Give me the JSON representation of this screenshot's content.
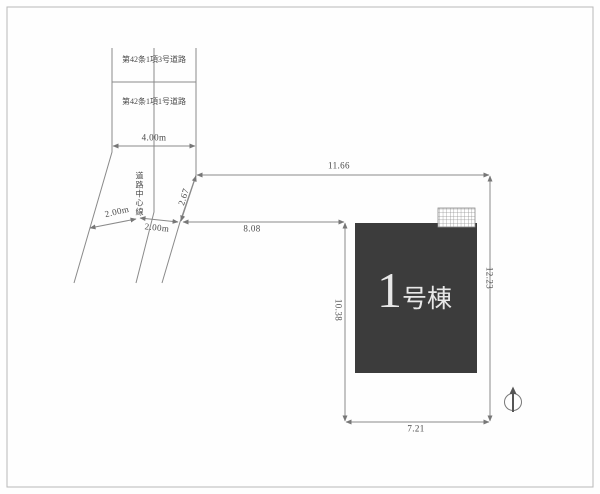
{
  "site_plan": {
    "road": {
      "upper_section_label": "第42条1項3号道路",
      "lower_section_label": "第42条1項1号道路",
      "total_width": "4.00m",
      "center_line_label": "道路中心線",
      "half_width_left": "2.00m",
      "half_width_right": "2.00m",
      "frontage_length": "2.67"
    },
    "lot_dimensions": {
      "north_edge": "11.66",
      "northwest_edge": "8.08",
      "east_edge": "12.23",
      "south_edge": "7.21",
      "west_edge": "10.38"
    },
    "building": {
      "number": "1",
      "suffix": "号棟",
      "fill_color": "#3c3c3c",
      "label_color": "#e8e8e8"
    },
    "colors": {
      "line": "#8a8a8a",
      "text": "#4a4a4a",
      "frame": "#b8b8b8"
    },
    "compass": {
      "icon": "north-arrow"
    }
  }
}
